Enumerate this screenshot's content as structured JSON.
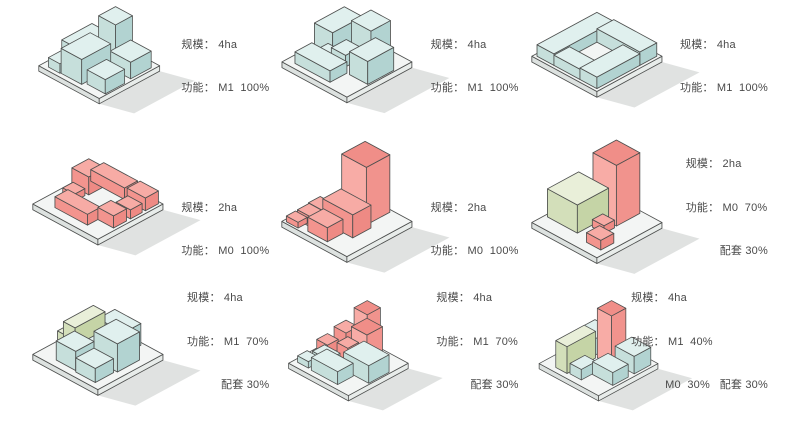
{
  "palette": {
    "outline": "#4d4f4e",
    "shadow": "#c6cac8",
    "label_color": "#4a4a4a",
    "plate": {
      "top": "#f3f5f4",
      "left": "#dde2e0",
      "right": "#e8ecea"
    },
    "blue": {
      "top": "#e0f0ee",
      "left": "#c6dfdb",
      "right": "#b2d3d1"
    },
    "pink": {
      "top": "#f7aba5",
      "left": "#f3948e",
      "right": "#ee8a84"
    },
    "pinkTall": {
      "top": "#f08e88",
      "left": "#f8aca6",
      "right": "#f1938d"
    },
    "green": {
      "top": "#e9efd9",
      "left": "#d3dfba",
      "right": "#c5d4a6"
    }
  },
  "cells": [
    {
      "name": "scheme-1",
      "lines": [
        "规模： 4ha",
        "功能： M1  100%"
      ],
      "blocks": [
        [
          3.2,
          0.5,
          2.8,
          2.8,
          6.5,
          "blue"
        ],
        [
          0.3,
          1.5,
          2.7,
          5.0,
          2.6,
          "blue"
        ],
        [
          6.2,
          1.0,
          3.4,
          3.4,
          2.8,
          "blue"
        ],
        [
          3.0,
          4.5,
          3.4,
          4.8,
          4.2,
          "blue"
        ],
        [
          6.8,
          5.6,
          3.0,
          3.2,
          2.4,
          "blue"
        ],
        [
          1.0,
          7.0,
          1.9,
          2.4,
          1.6,
          "blue"
        ]
      ]
    },
    {
      "name": "scheme-2",
      "lines": [
        "规模： 4ha",
        "功能： M1  100%"
      ],
      "blocks": [
        [
          0.4,
          0.8,
          2.8,
          4.6,
          3.8,
          "blue"
        ],
        [
          4.0,
          0.3,
          3.0,
          3.0,
          5.0,
          "blue"
        ],
        [
          3.4,
          3.5,
          2.2,
          2.3,
          1.8,
          "blue"
        ],
        [
          7.0,
          2.6,
          2.8,
          4.0,
          3.6,
          "blue"
        ],
        [
          1.2,
          6.6,
          5.4,
          2.6,
          1.8,
          "blue"
        ],
        [
          2.0,
          4.9,
          2.0,
          1.5,
          1.2,
          "blue"
        ]
      ]
    },
    {
      "name": "scheme-3",
      "lines": [
        "规模： 4ha",
        "功能： M1  100%"
      ],
      "blocks": [
        [
          0.4,
          0.4,
          2.6,
          9.2,
          1.8,
          "blue"
        ],
        [
          3.0,
          0.4,
          6.6,
          2.6,
          2.1,
          "blue"
        ],
        [
          7.0,
          3.0,
          2.6,
          6.6,
          1.8,
          "blue"
        ],
        [
          3.0,
          7.2,
          4.0,
          2.4,
          1.6,
          "blue"
        ]
      ]
    },
    {
      "name": "scheme-4",
      "lines": [
        "规模： 2ha",
        "功能： M0  100%"
      ],
      "blocks": [
        [
          0.4,
          1.8,
          2.6,
          2.6,
          2.8,
          "pink"
        ],
        [
          1.2,
          0.3,
          5.2,
          2.0,
          1.8,
          "pink"
        ],
        [
          6.8,
          0.3,
          2.8,
          2.0,
          2.0,
          "pink"
        ],
        [
          7.4,
          2.8,
          2.2,
          1.8,
          1.4,
          "pink"
        ],
        [
          7.2,
          5.2,
          2.4,
          2.0,
          1.9,
          "pink"
        ],
        [
          2.2,
          6.8,
          5.0,
          2.0,
          1.7,
          "pink"
        ],
        [
          1.0,
          4.8,
          1.8,
          1.6,
          1.1,
          "pink"
        ]
      ]
    },
    {
      "name": "scheme-5",
      "lines": [
        "规模： 2ha",
        "功能： M0  100%"
      ],
      "blocks": [
        [
          3.2,
          0.4,
          3.8,
          3.6,
          9.0,
          "pinkTall"
        ],
        [
          3.2,
          4.1,
          4.6,
          2.8,
          3.6,
          "pink"
        ],
        [
          3.4,
          7.0,
          3.0,
          2.4,
          2.2,
          "pink"
        ],
        [
          0.5,
          4.6,
          2.0,
          1.8,
          1.2,
          "pink"
        ],
        [
          1.0,
          6.8,
          2.0,
          1.8,
          1.6,
          "pink"
        ],
        [
          0.4,
          8.3,
          1.8,
          1.4,
          0.9,
          "pink"
        ]
      ]
    },
    {
      "name": "scheme-6",
      "lines": [
        "规模： 2ha",
        "功能： M0  70%",
        "配套 30%"
      ],
      "blocks": [
        [
          3.4,
          0.4,
          3.6,
          3.6,
          9.5,
          "pinkTall"
        ],
        [
          0.4,
          3.2,
          4.6,
          4.8,
          4.4,
          "green"
        ],
        [
          5.3,
          4.4,
          1.8,
          1.6,
          1.2,
          "pink"
        ],
        [
          7.0,
          6.6,
          2.2,
          2.0,
          1.5,
          "pink"
        ]
      ]
    },
    {
      "name": "scheme-7",
      "lines": [
        "规模： 4ha",
        "功能： M1  70%",
        "配套 30%"
      ],
      "blocks": [
        [
          3.0,
          0.4,
          4.0,
          2.6,
          3.4,
          "blue"
        ],
        [
          0.2,
          3.4,
          1.2,
          3.0,
          1.8,
          "green"
        ],
        [
          1.5,
          2.2,
          1.8,
          4.6,
          4.2,
          "green"
        ],
        [
          5.4,
          2.6,
          3.6,
          3.4,
          4.4,
          "blue"
        ],
        [
          3.5,
          3.6,
          1.8,
          2.0,
          1.6,
          "blue"
        ],
        [
          2.6,
          6.2,
          3.0,
          2.8,
          3.0,
          "blue"
        ],
        [
          5.8,
          6.4,
          3.0,
          2.8,
          2.2,
          "blue"
        ]
      ]
    },
    {
      "name": "scheme-8",
      "lines": [
        "规模： 4ha",
        "功能： M1  70%",
        "配套 30%"
      ],
      "blocks": [
        [
          3.4,
          0.3,
          2.6,
          2.6,
          4.2,
          "pinkTall"
        ],
        [
          3.6,
          0.45,
          2.2,
          2.2,
          3.2,
          "pinkTall",
          4.2
        ],
        [
          1.4,
          1.8,
          2.0,
          2.0,
          3.6,
          "pink"
        ],
        [
          0.3,
          3.8,
          1.8,
          1.8,
          1.8,
          "pink"
        ],
        [
          3.2,
          3.3,
          1.8,
          1.8,
          2.6,
          "pink"
        ],
        [
          5.6,
          3.0,
          4.2,
          3.4,
          3.0,
          "blue"
        ],
        [
          1.6,
          5.6,
          2.6,
          2.0,
          1.6,
          "blue"
        ],
        [
          3.0,
          6.6,
          4.4,
          2.6,
          2.2,
          "blue"
        ],
        [
          0.6,
          7.5,
          1.8,
          1.6,
          1.1,
          "blue"
        ]
      ]
    },
    {
      "name": "scheme-9",
      "lines": [
        "规模： 4ha",
        "功能： M1  40%",
        "M0  30%   配套 30%"
      ],
      "blocks": [
        [
          0.4,
          1.0,
          3.0,
          3.6,
          2.8,
          "blue"
        ],
        [
          6.4,
          0.8,
          3.2,
          2.8,
          3.0,
          "blue"
        ],
        [
          4.0,
          1.8,
          2.4,
          2.4,
          8.5,
          "pinkTall"
        ],
        [
          2.0,
          4.4,
          1.9,
          4.8,
          4.6,
          "green"
        ],
        [
          6.2,
          4.6,
          3.4,
          2.6,
          2.2,
          "blue"
        ],
        [
          4.2,
          6.5,
          1.9,
          2.5,
          1.8,
          "blue"
        ],
        [
          0.3,
          5.4,
          1.6,
          2.0,
          1.3,
          "blue"
        ]
      ]
    }
  ]
}
